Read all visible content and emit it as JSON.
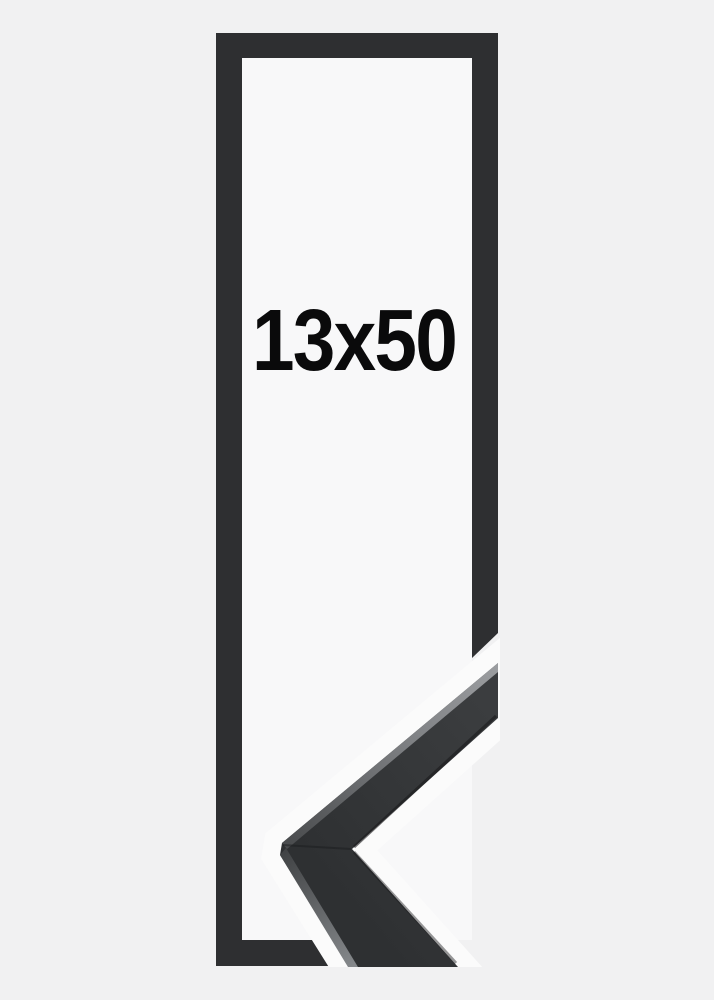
{
  "image": {
    "size_label": "13x50",
    "description": "Product photo of a tall narrow black picture frame shown with a diagonal break and a close-up mitred corner sample of the black moulding at the lower right",
    "frame_color_name": "black",
    "colors": {
      "background": "#f1f1f2",
      "frame_interior": "#f8f8f9",
      "frame": "#2e2f31",
      "sample_face": "#323436",
      "sample_highlight": "#9b9da0",
      "halo": "#fbfbfb",
      "label_text": "#0a0a0b"
    }
  }
}
